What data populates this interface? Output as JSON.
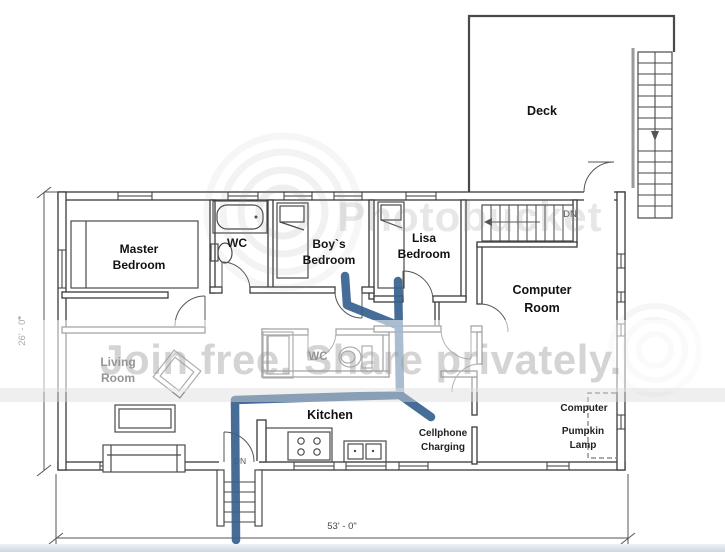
{
  "title": "House floor plan with cellphone charging route",
  "rooms": {
    "master": {
      "line1": "Master",
      "line2": "Bedroom"
    },
    "wc_top": {
      "label": "WC"
    },
    "boys": {
      "line1": "Boy`s",
      "line2": "Bedroom"
    },
    "lisa": {
      "line1": "Lisa",
      "line2": "Bedroom"
    },
    "computer": {
      "line1": "Computer",
      "line2": "Room"
    },
    "living": {
      "line1": "Living",
      "line2": "Room"
    },
    "wc_mid": {
      "label": "WC"
    },
    "kitchen": {
      "label": "Kitchen"
    },
    "deck": {
      "label": "Deck"
    }
  },
  "annotations": {
    "cellphone": {
      "line1": "Cellphone",
      "line2": "Charging"
    },
    "computer_device": "Computer",
    "pumpkin": {
      "line1": "Pumpkin",
      "line2": "Lamp"
    },
    "dn_upper": "DN",
    "dn_entry": "DN"
  },
  "dimensions": {
    "width_label": "53' - 0\"",
    "height_label": "26' - 0\""
  },
  "watermark": {
    "brand": "Photobucket",
    "tagline": "Join free. Share privately."
  },
  "route": {
    "color": "#36618f"
  }
}
